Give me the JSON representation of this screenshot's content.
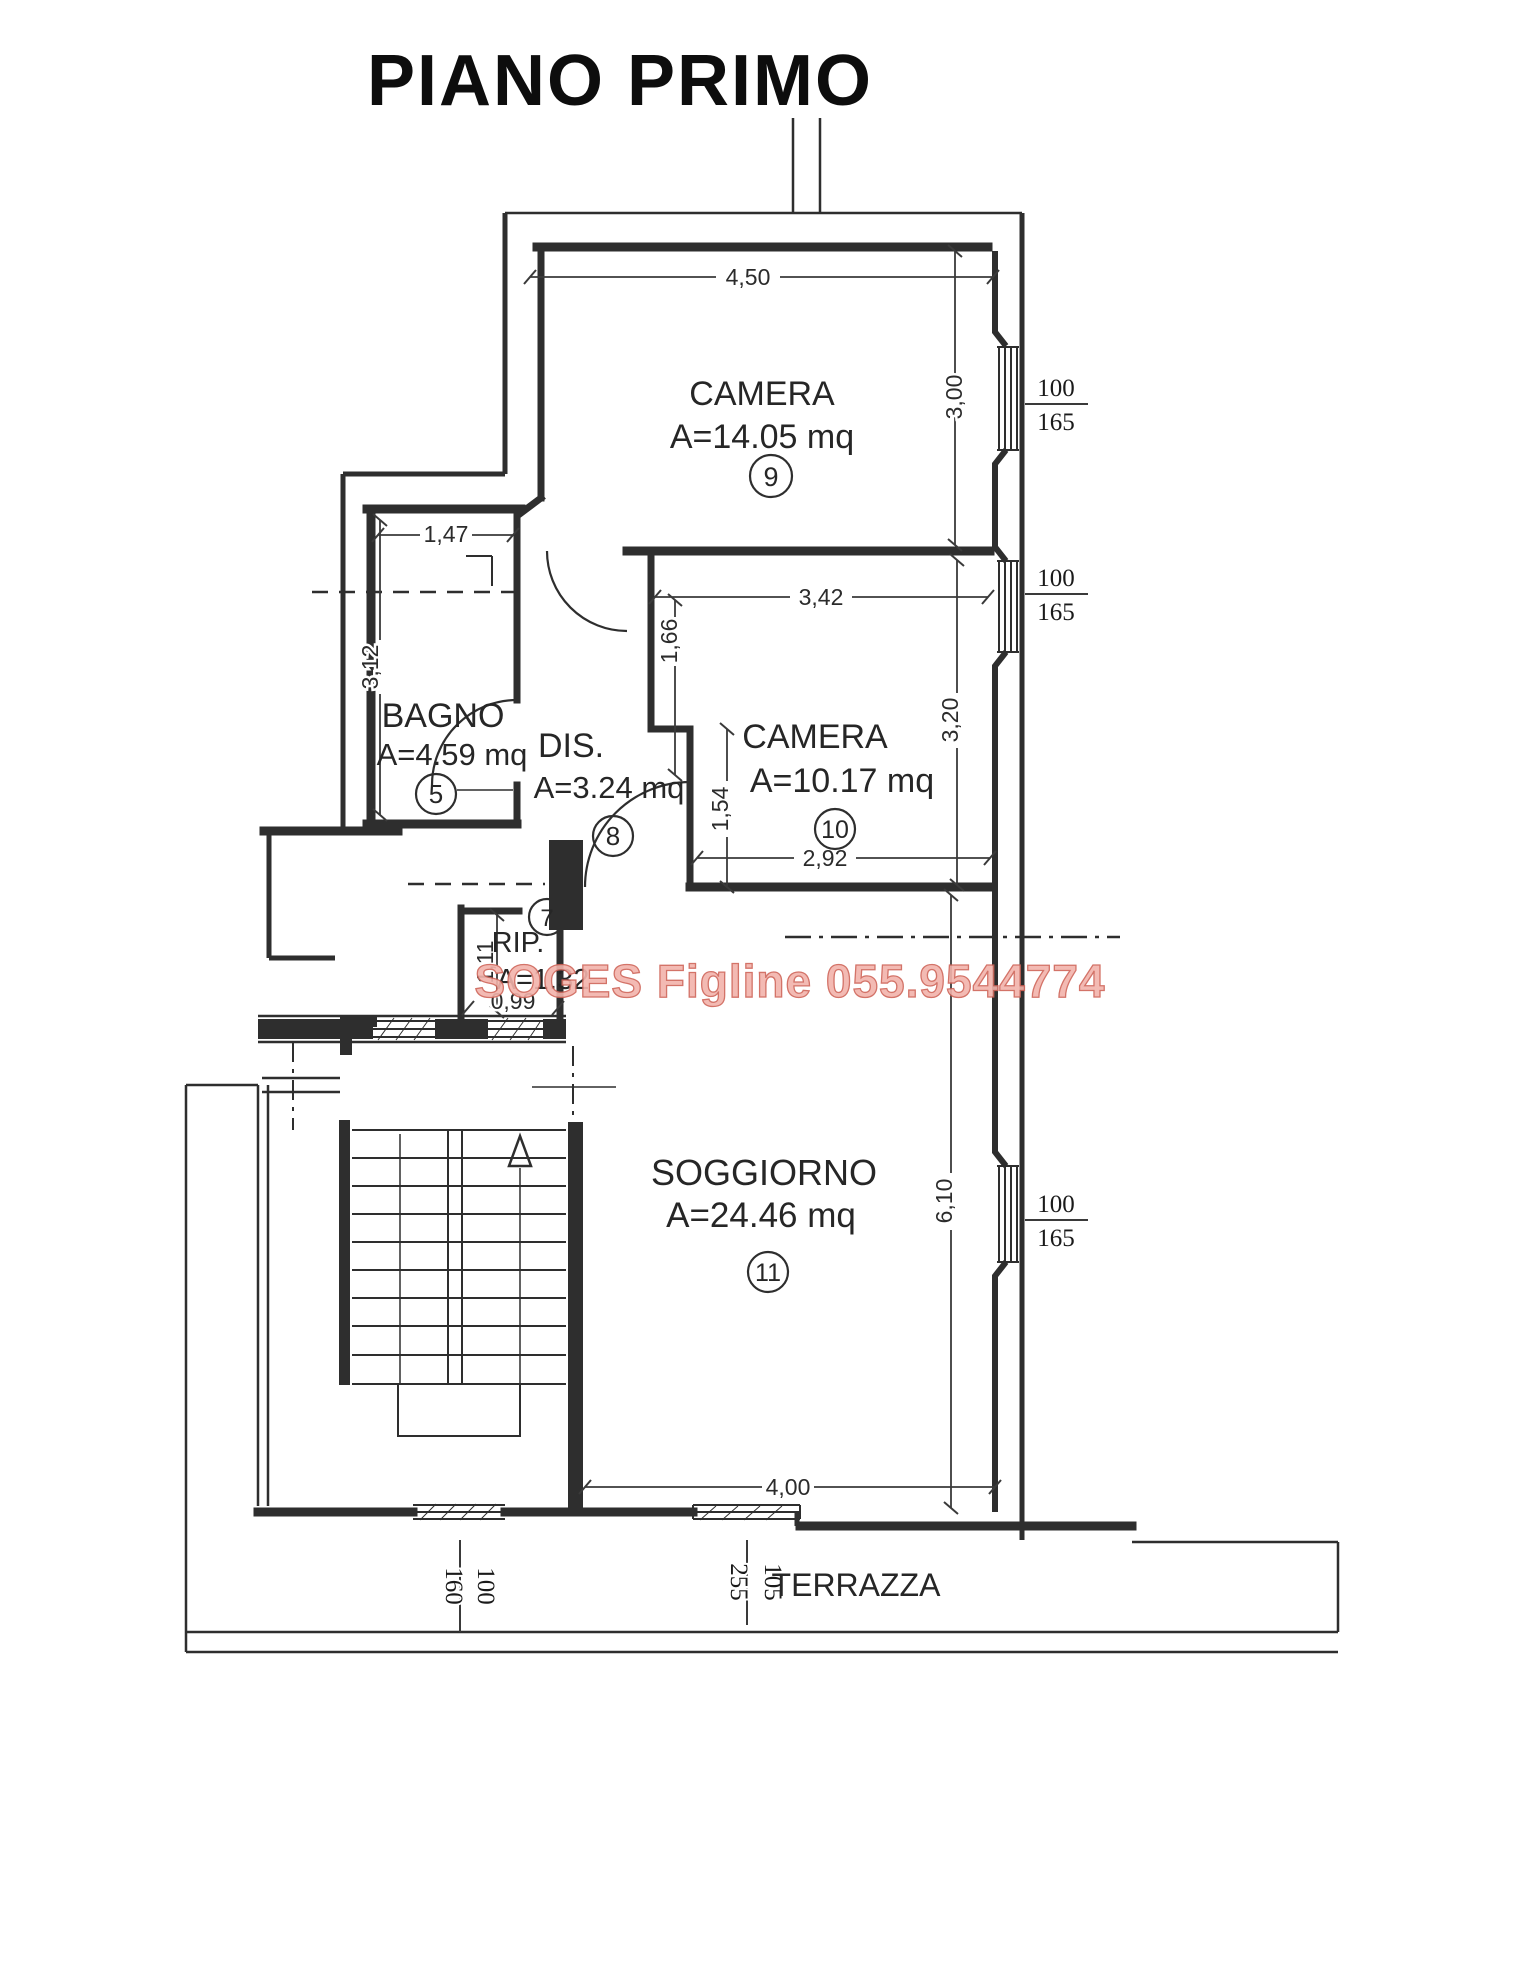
{
  "title": "PIANO PRIMO",
  "watermark": "SOGES Figline 055.9544774",
  "colors": {
    "line": "#2e2e2e",
    "watermark_fill": "#f2b3ab",
    "watermark_edge": "#cf6458"
  },
  "rooms": {
    "camera9": {
      "label": "CAMERA",
      "area": "A=14.05 mq",
      "num": "9"
    },
    "camera10": {
      "label": "CAMERA",
      "area": "A=10.17 mq",
      "num": "10"
    },
    "bagno": {
      "label": "BAGNO",
      "area": "A=4.59 mq",
      "num": "5"
    },
    "dis": {
      "label": "DIS.",
      "area": "A=3.24 mq",
      "num": "8"
    },
    "rip": {
      "label": "RIP.",
      "area": "A=1.32",
      "num": "7"
    },
    "soggiorno": {
      "label": "SOGGIORNO",
      "area": "A=24.46 mq",
      "num": "11"
    },
    "terrazza": {
      "label": "TERRAZZA"
    }
  },
  "dims": {
    "top_width": "4,50",
    "camera9_height": "3,00",
    "bagno_width": "1,47",
    "bagno_height": "3,12",
    "camera10_width": "3,42",
    "camera10_upper": "1,66",
    "camera10_lower": "1,54",
    "camera10_bottom": "2,92",
    "camera10_height": "3,20",
    "soggiorno_height": "6,10",
    "soggiorno_width": "4,00",
    "rip_height": "1,11",
    "rip_width": "0,99"
  },
  "windows": {
    "camera9": {
      "num": "100",
      "den": "165"
    },
    "camera10": {
      "num": "100",
      "den": "165"
    },
    "soggiorno": {
      "num": "100",
      "den": "165"
    },
    "stairwell": {
      "num": "100",
      "den": "160"
    },
    "terrace": {
      "num": "105",
      "den": "255"
    }
  }
}
